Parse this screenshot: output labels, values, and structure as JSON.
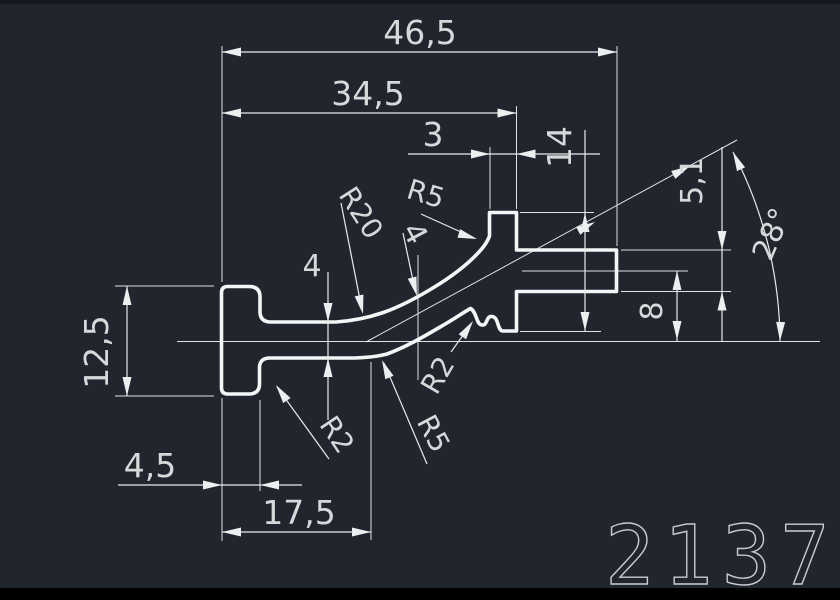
{
  "drawing": {
    "part_number": "2137",
    "dims": {
      "overall_width": "46,5",
      "upper_width": "34,5",
      "tab_width": "3",
      "block_height": "14",
      "arm_thickness": "5,1",
      "angle": "28°",
      "flange_height": "12,5",
      "web_thickness": "4",
      "web_thickness_upper": "4",
      "arm_offset": "8",
      "flange_width": "4,5",
      "foot_length": "17,5"
    },
    "radii": {
      "r20": "R20",
      "r5_top": "R5",
      "r2_right": "R2",
      "r5_bottom": "R5",
      "r2_left": "R2"
    },
    "colors": {
      "background": "#21252d",
      "lines": "#e8eaec",
      "text": "#d6d8da",
      "bottom_bar": "#000000"
    }
  }
}
